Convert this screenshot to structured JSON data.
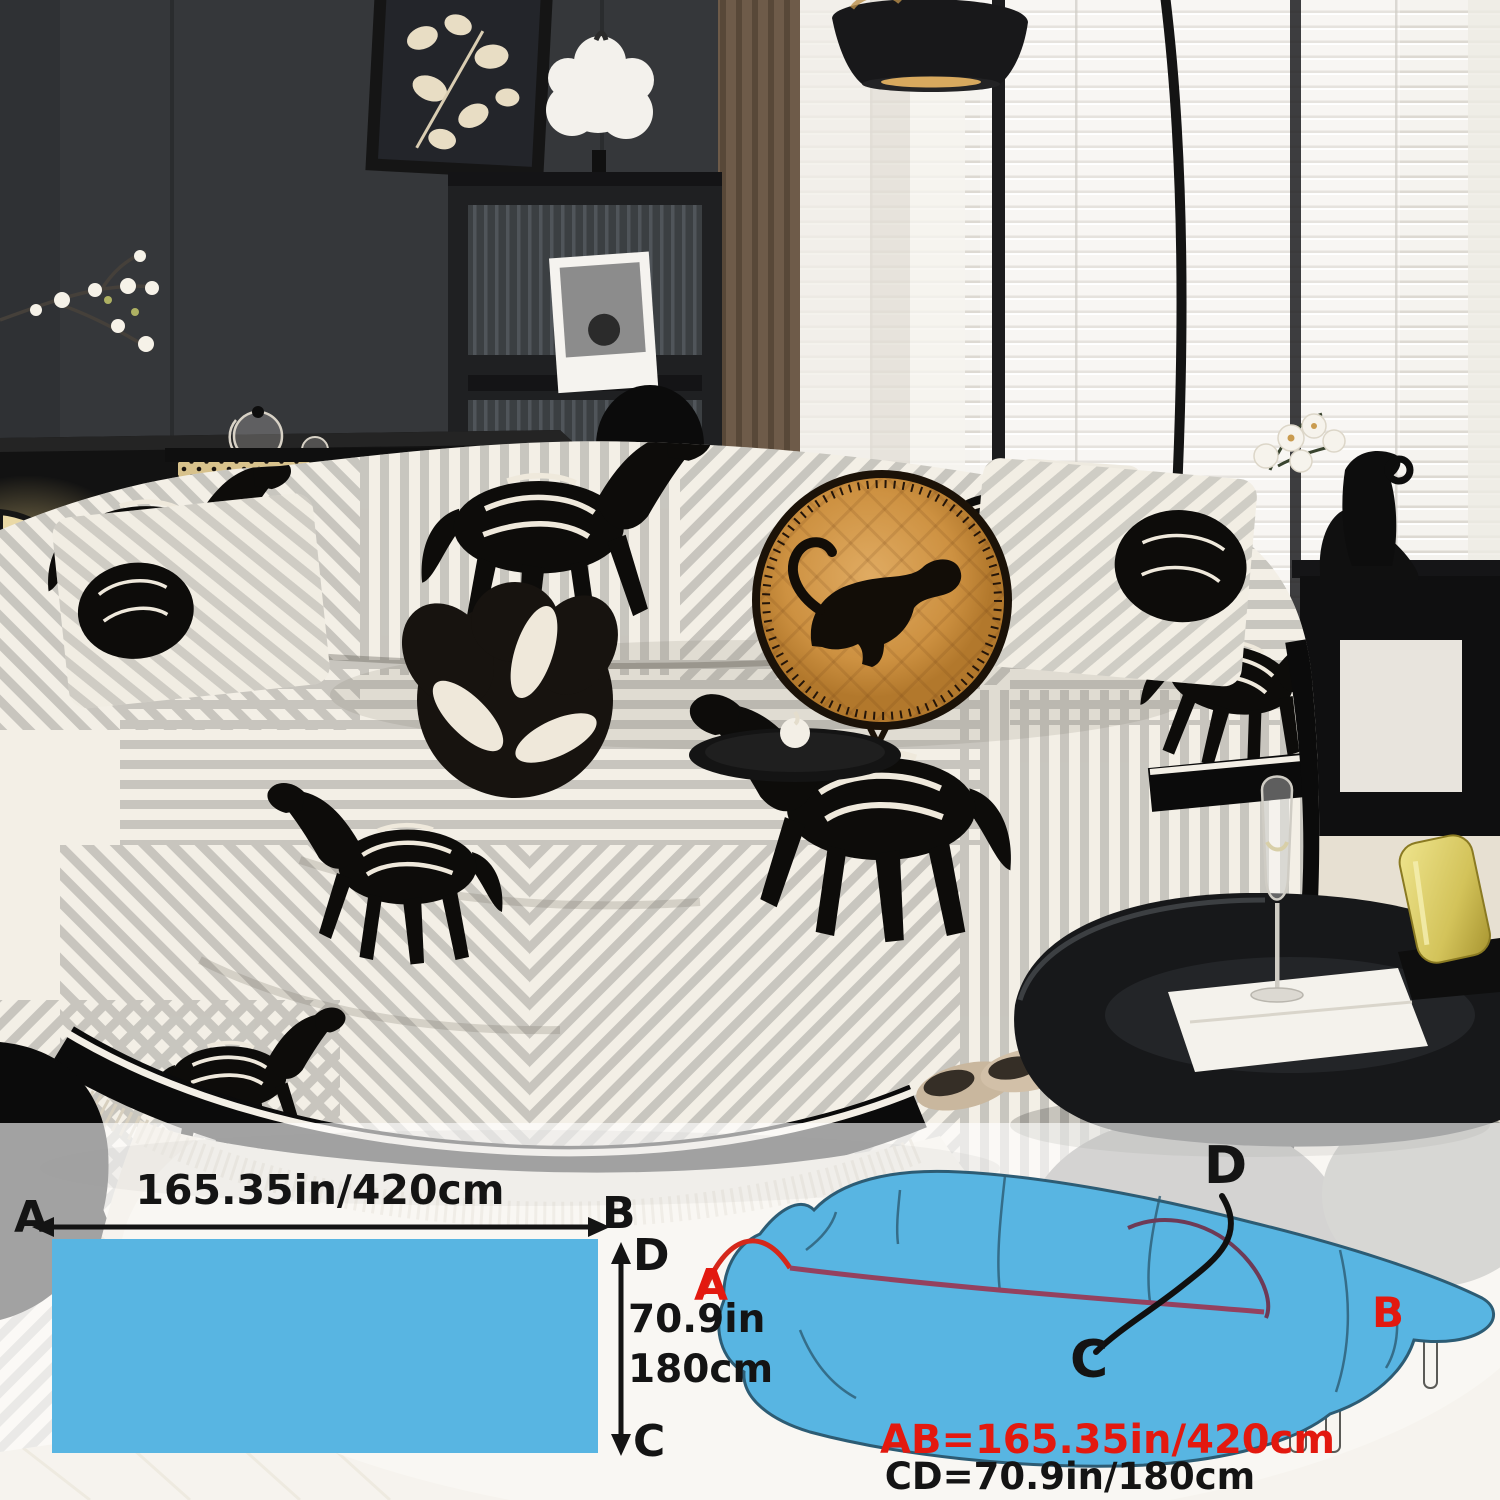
{
  "size_diagram": {
    "swatch": {
      "label_a": "A",
      "label_b": "B",
      "label_c": "C",
      "label_d": "D",
      "width_label": "165.35in/420cm",
      "height_label_in": "70.9in",
      "height_label_cm": "180cm",
      "fill_color": "#58b5e2"
    },
    "sofa_sketch": {
      "label_a": "A",
      "label_b": "B",
      "label_c": "C",
      "label_d": "D",
      "ab_dimension": "AB=165.35in/420cm",
      "cd_dimension": "CD=70.9in/180cm",
      "accent_red": "#e3190f",
      "text_black": "#141414",
      "cover_color": "#58b5e2"
    }
  }
}
